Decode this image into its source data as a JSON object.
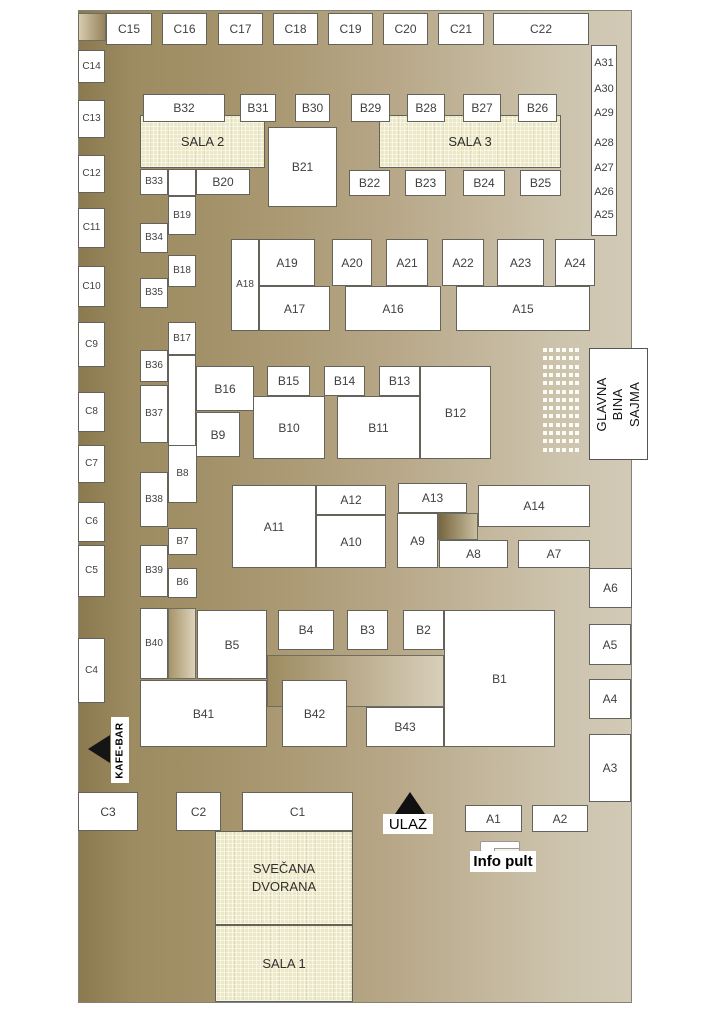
{
  "labels": {
    "entrance": "ULAZ",
    "info_desk": "Info pult",
    "cafe_bar": "KAFE-BAR",
    "main_stage": "GLAVNA BINA\nSAJMA"
  },
  "colors": {
    "floor_dark": "#8b7950",
    "floor_light": "#d2cab6",
    "booth_fill": "#ffffff",
    "booth_border": "#63635b",
    "hall_fill": "#ece8c6",
    "marker_black": "#101010"
  },
  "halls": [
    {
      "id": "sala-2",
      "label": "SALA 2",
      "box": [
        140,
        115,
        125,
        53
      ]
    },
    {
      "id": "sala-3",
      "label": "SALA 3",
      "box": [
        379,
        115,
        182,
        53
      ]
    },
    {
      "id": "svecana-dvorana",
      "label": "SVEČANA\nDVORANA",
      "box": [
        215,
        831,
        138,
        94
      ]
    },
    {
      "id": "sala-1",
      "label": "SALA 1",
      "box": [
        215,
        925,
        138,
        77
      ]
    }
  ],
  "right_column": {
    "box": [
      591,
      45,
      26,
      191
    ],
    "labels": [
      "A31",
      "A30",
      "A29",
      "A28",
      "A27",
      "A26",
      "A25"
    ],
    "offsets": [
      11,
      37,
      61,
      91,
      116,
      140,
      163
    ]
  },
  "stage_seats": {
    "origin": [
      543,
      348
    ],
    "rows": 13,
    "row_step": 8.3,
    "col_offsets": [
      0,
      6,
      13,
      19,
      26,
      32
    ]
  },
  "decor": [
    {
      "id": "corner-cell",
      "box": [
        78,
        13,
        28,
        28
      ],
      "fill": "linear-gradient(90deg,#d8ccb0,#94825a)"
    },
    {
      "id": "b40-side-cell",
      "box": [
        168,
        608,
        28,
        71
      ],
      "fill": "linear-gradient(90deg,#a6946a,#ddd3bb)"
    },
    {
      "id": "platform",
      "box": [
        267,
        655,
        177,
        52
      ],
      "fill": "linear-gradient(90deg,#9d8b61,#d8cfba)"
    },
    {
      "id": "a14-side-cell",
      "box": [
        438,
        513,
        40,
        27
      ],
      "fill": "linear-gradient(90deg,#77663f,#c9bf9f)"
    }
  ],
  "booths": [
    {
      "label": "C15",
      "box": [
        106,
        13,
        46,
        32
      ]
    },
    {
      "label": "C16",
      "box": [
        162,
        13,
        45,
        32
      ]
    },
    {
      "label": "C17",
      "box": [
        218,
        13,
        45,
        32
      ]
    },
    {
      "label": "C18",
      "box": [
        273,
        13,
        45,
        32
      ]
    },
    {
      "label": "C19",
      "box": [
        328,
        13,
        45,
        32
      ]
    },
    {
      "label": "C20",
      "box": [
        383,
        13,
        45,
        32
      ]
    },
    {
      "label": "C21",
      "box": [
        438,
        13,
        46,
        32
      ]
    },
    {
      "label": "C22",
      "box": [
        493,
        13,
        96,
        32
      ]
    },
    {
      "label": "C14",
      "box": [
        78,
        50,
        27,
        33
      ]
    },
    {
      "label": "C13",
      "box": [
        78,
        100,
        27,
        38
      ]
    },
    {
      "label": "C12",
      "box": [
        78,
        155,
        27,
        38
      ]
    },
    {
      "label": "C11",
      "box": [
        78,
        208,
        27,
        40
      ]
    },
    {
      "label": "C10",
      "box": [
        78,
        266,
        27,
        41
      ]
    },
    {
      "label": "C9",
      "box": [
        78,
        322,
        27,
        45
      ]
    },
    {
      "label": "C8",
      "box": [
        78,
        392,
        27,
        40
      ]
    },
    {
      "label": "C7",
      "box": [
        78,
        445,
        27,
        38
      ]
    },
    {
      "label": "C6",
      "box": [
        78,
        502,
        27,
        40
      ]
    },
    {
      "label": "C5",
      "box": [
        78,
        545,
        27,
        52
      ]
    },
    {
      "label": "C4",
      "box": [
        78,
        638,
        27,
        65
      ]
    },
    {
      "label": "C3",
      "box": [
        78,
        792,
        60,
        39
      ]
    },
    {
      "label": "C2",
      "box": [
        176,
        792,
        45,
        39
      ]
    },
    {
      "label": "C1",
      "box": [
        242,
        792,
        111,
        39
      ]
    },
    {
      "label": "B32",
      "box": [
        143,
        94,
        82,
        28
      ]
    },
    {
      "label": "B31",
      "box": [
        240,
        94,
        36,
        28
      ]
    },
    {
      "label": "B30",
      "box": [
        295,
        94,
        35,
        28
      ]
    },
    {
      "label": "B29",
      "box": [
        351,
        94,
        39,
        28
      ]
    },
    {
      "label": "B28",
      "box": [
        407,
        94,
        38,
        28
      ]
    },
    {
      "label": "B27",
      "box": [
        463,
        94,
        38,
        28
      ]
    },
    {
      "label": "B26",
      "box": [
        518,
        94,
        39,
        28
      ]
    },
    {
      "label": "B21",
      "box": [
        268,
        127,
        69,
        80
      ]
    },
    {
      "label": "B33",
      "box": [
        140,
        169,
        28,
        26
      ]
    },
    {
      "label": "",
      "box": [
        168,
        169,
        28,
        27
      ]
    },
    {
      "label": "B20",
      "box": [
        196,
        169,
        54,
        26
      ]
    },
    {
      "label": "B22",
      "box": [
        349,
        170,
        41,
        26
      ]
    },
    {
      "label": "B23",
      "box": [
        405,
        170,
        41,
        26
      ]
    },
    {
      "label": "B24",
      "box": [
        463,
        170,
        42,
        26
      ]
    },
    {
      "label": "B25",
      "box": [
        520,
        170,
        41,
        26
      ]
    },
    {
      "label": "B19",
      "box": [
        168,
        196,
        28,
        39
      ]
    },
    {
      "label": "B34",
      "box": [
        140,
        223,
        28,
        30
      ]
    },
    {
      "label": "B18",
      "box": [
        168,
        255,
        28,
        32
      ]
    },
    {
      "label": "B35",
      "box": [
        140,
        278,
        28,
        30
      ]
    },
    {
      "label": "B17",
      "box": [
        168,
        322,
        28,
        33
      ]
    },
    {
      "label": "B36",
      "box": [
        140,
        350,
        28,
        32
      ]
    },
    {
      "label": "",
      "box": [
        168,
        355,
        28,
        102
      ]
    },
    {
      "label": "B37",
      "box": [
        140,
        385,
        28,
        58
      ]
    },
    {
      "label": "B16",
      "box": [
        196,
        366,
        58,
        45
      ]
    },
    {
      "label": "B9",
      "box": [
        196,
        412,
        44,
        45
      ]
    },
    {
      "label": "B15",
      "box": [
        267,
        366,
        43,
        30
      ]
    },
    {
      "label": "B10",
      "box": [
        253,
        396,
        72,
        63
      ]
    },
    {
      "label": "B14",
      "box": [
        324,
        366,
        41,
        30
      ]
    },
    {
      "label": "B13",
      "box": [
        379,
        366,
        41,
        30
      ]
    },
    {
      "label": "B11",
      "box": [
        337,
        396,
        83,
        63
      ]
    },
    {
      "label": "B12",
      "box": [
        420,
        366,
        71,
        93
      ]
    },
    {
      "label": "B8",
      "box": [
        168,
        445,
        29,
        58
      ]
    },
    {
      "label": "B38",
      "box": [
        140,
        472,
        28,
        55
      ]
    },
    {
      "label": "B7",
      "box": [
        168,
        528,
        29,
        27
      ]
    },
    {
      "label": "B39",
      "box": [
        140,
        545,
        28,
        52
      ]
    },
    {
      "label": "B6",
      "box": [
        168,
        568,
        29,
        30
      ]
    },
    {
      "label": "B40",
      "box": [
        140,
        608,
        28,
        71
      ]
    },
    {
      "label": "B5",
      "box": [
        197,
        610,
        70,
        69
      ]
    },
    {
      "label": "B4",
      "box": [
        278,
        610,
        56,
        40
      ]
    },
    {
      "label": "B3",
      "box": [
        347,
        610,
        41,
        40
      ]
    },
    {
      "label": "B2",
      "box": [
        403,
        610,
        41,
        40
      ]
    },
    {
      "label": "B1",
      "box": [
        444,
        610,
        111,
        137
      ]
    },
    {
      "label": "B41",
      "box": [
        140,
        680,
        127,
        67
      ]
    },
    {
      "label": "B42",
      "box": [
        282,
        680,
        65,
        67
      ]
    },
    {
      "label": "B43",
      "box": [
        366,
        707,
        78,
        40
      ]
    },
    {
      "label": "A18",
      "box": [
        231,
        239,
        28,
        92
      ]
    },
    {
      "label": "A19",
      "box": [
        259,
        239,
        56,
        47
      ]
    },
    {
      "label": "A20",
      "box": [
        332,
        239,
        40,
        47
      ]
    },
    {
      "label": "A21",
      "box": [
        386,
        239,
        42,
        47
      ]
    },
    {
      "label": "A22",
      "box": [
        442,
        239,
        42,
        47
      ]
    },
    {
      "label": "A23",
      "box": [
        497,
        239,
        47,
        47
      ]
    },
    {
      "label": "A24",
      "box": [
        555,
        239,
        40,
        47
      ]
    },
    {
      "label": "A17",
      "box": [
        259,
        286,
        71,
        45
      ]
    },
    {
      "label": "A16",
      "box": [
        345,
        286,
        96,
        45
      ]
    },
    {
      "label": "A15",
      "box": [
        456,
        286,
        134,
        45
      ]
    },
    {
      "label": "A11",
      "box": [
        232,
        485,
        84,
        83
      ]
    },
    {
      "label": "A12",
      "box": [
        316,
        485,
        70,
        30
      ]
    },
    {
      "label": "A10",
      "box": [
        316,
        515,
        70,
        53
      ]
    },
    {
      "label": "A13",
      "box": [
        398,
        483,
        69,
        30
      ]
    },
    {
      "label": "A9",
      "box": [
        397,
        513,
        41,
        55
      ]
    },
    {
      "label": "A14",
      "box": [
        478,
        485,
        112,
        42
      ]
    },
    {
      "label": "A8",
      "box": [
        439,
        540,
        69,
        28
      ]
    },
    {
      "label": "A7",
      "box": [
        518,
        540,
        72,
        28
      ]
    },
    {
      "label": "A6",
      "box": [
        589,
        568,
        43,
        40
      ]
    },
    {
      "label": "A5",
      "box": [
        589,
        624,
        42,
        41
      ]
    },
    {
      "label": "A4",
      "box": [
        589,
        679,
        42,
        40
      ]
    },
    {
      "label": "A3",
      "box": [
        589,
        734,
        42,
        68
      ]
    },
    {
      "label": "A1",
      "box": [
        465,
        805,
        57,
        27
      ]
    },
    {
      "label": "A2",
      "box": [
        532,
        805,
        56,
        27
      ]
    }
  ]
}
